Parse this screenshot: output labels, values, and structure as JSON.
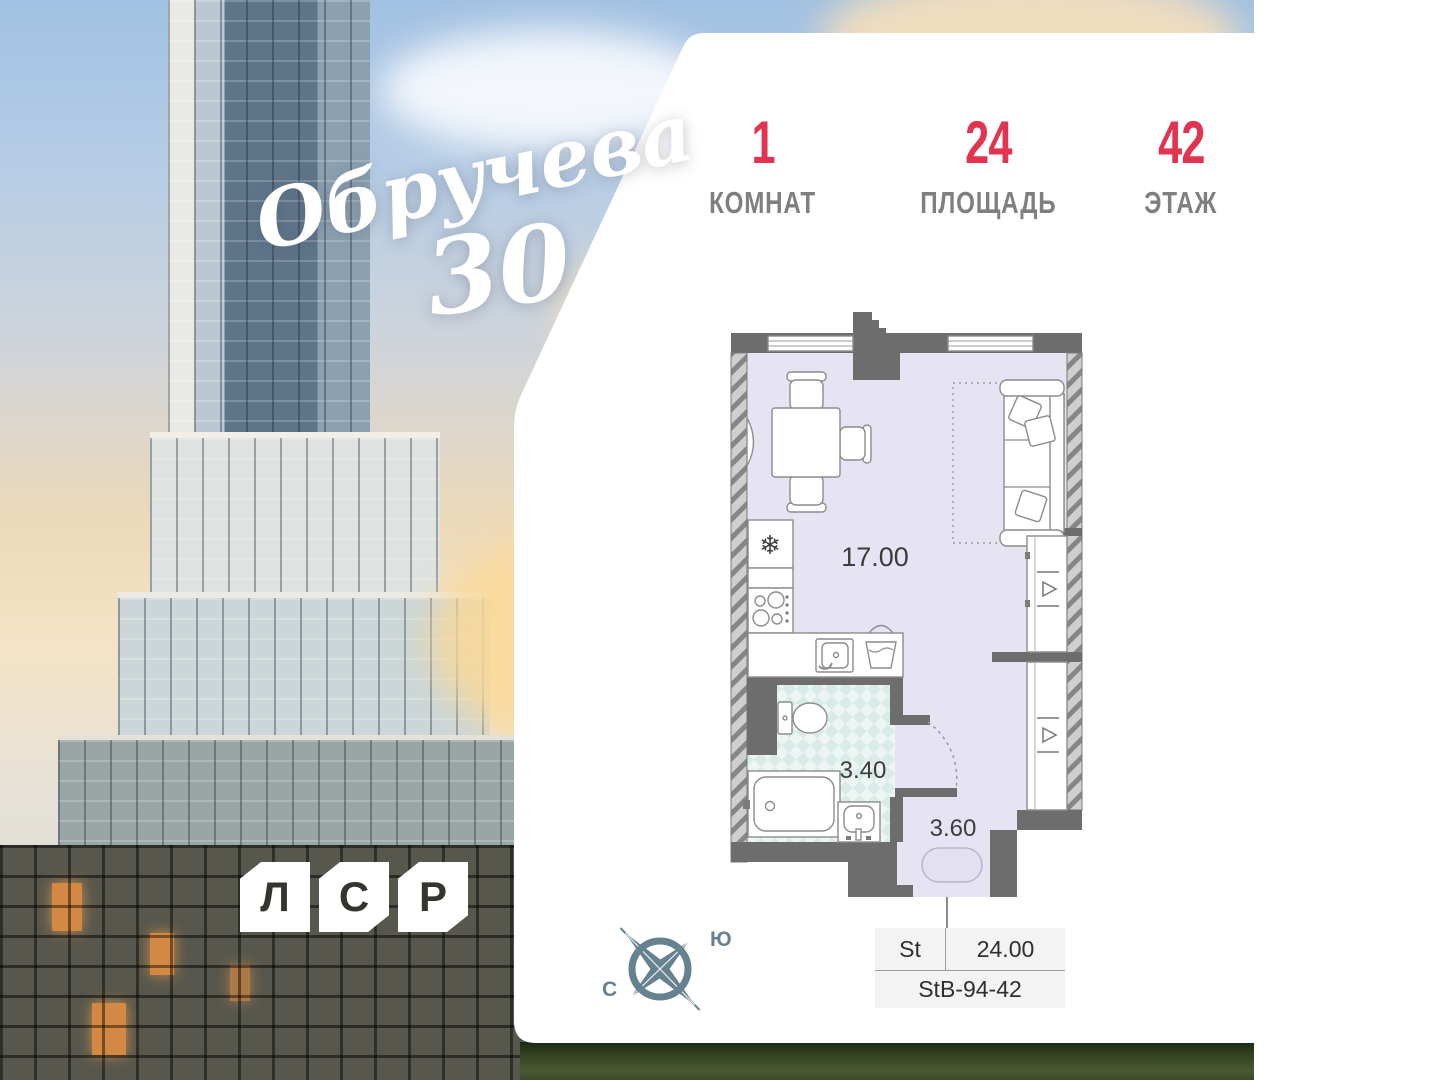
{
  "header": {
    "stats": [
      {
        "value": "1",
        "label": "КОМНАТ"
      },
      {
        "value": "24",
        "label": "ПЛОЩАДЬ"
      },
      {
        "value": "42",
        "label": "ЭТАЖ"
      }
    ],
    "accent_color": "#e23350"
  },
  "brand": {
    "project_name": "Обручева",
    "project_number": "30"
  },
  "developer": {
    "letters": [
      "Л",
      "С",
      "Р"
    ]
  },
  "floor_plan": {
    "rooms": [
      {
        "name": "living-kitchen",
        "area": "17.00"
      },
      {
        "name": "bathroom",
        "area": "3.40"
      },
      {
        "name": "hall",
        "area": "3.60"
      }
    ],
    "icons": {
      "snowflake": "❄"
    }
  },
  "compass": {
    "south_label": "Ю",
    "north_label": "С"
  },
  "info_table": {
    "type": "St",
    "area": "24.00",
    "unit_code": "StB-94-42"
  },
  "colors": {
    "accent": "#e23350",
    "wall": "#6d6d6d",
    "floor": "#e6e4f2",
    "bath_tile": "#d8ebe8",
    "compass": "#66818f"
  }
}
